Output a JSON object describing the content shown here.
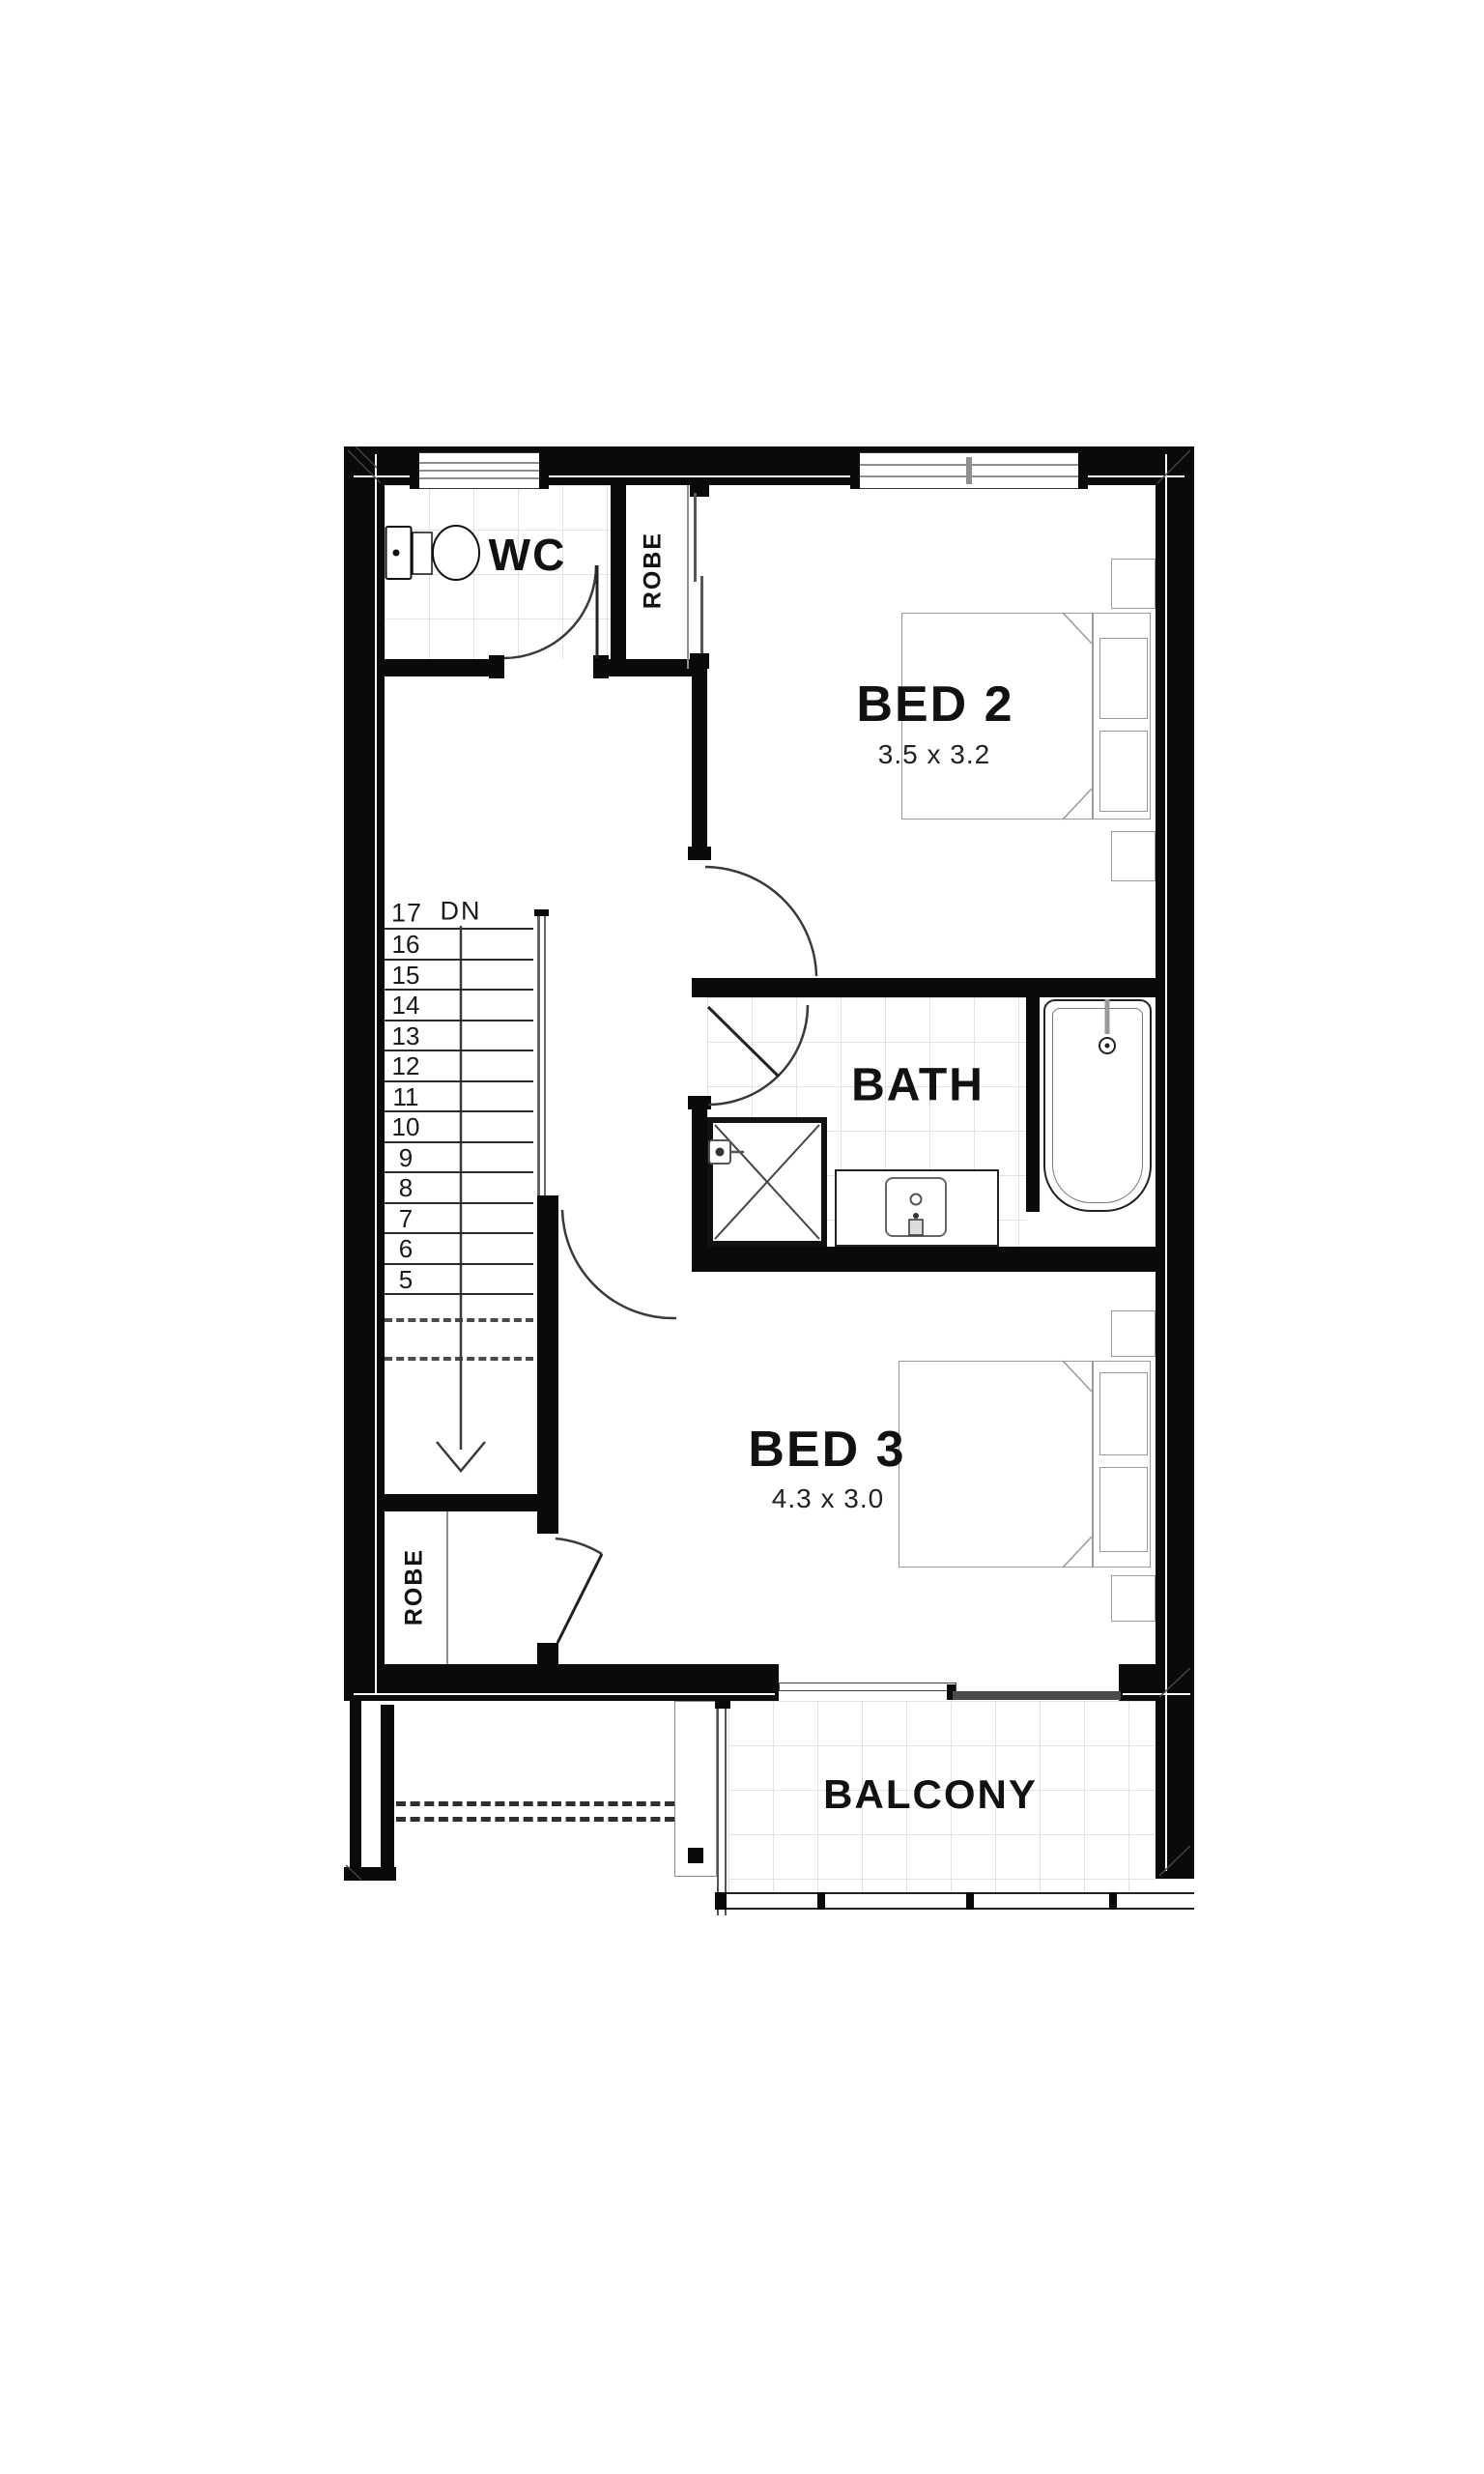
{
  "floorplan": {
    "rooms": {
      "wc": {
        "name": "WC"
      },
      "robe_upper": {
        "name": "ROBE"
      },
      "bed2": {
        "name": "BED 2",
        "size": "3.5 x 3.2"
      },
      "bath": {
        "name": "BATH"
      },
      "bed3": {
        "name": "BED 3",
        "size": "4.3 x 3.0"
      },
      "robe_lower": {
        "name": "ROBE"
      },
      "balcony": {
        "name": "BALCONY"
      }
    },
    "stairs": {
      "top_step": "17",
      "direction": "DN",
      "visible_steps": [
        "16",
        "15",
        "14",
        "13",
        "12",
        "11",
        "10",
        "9",
        "8",
        "7",
        "6",
        "5"
      ]
    }
  },
  "colors": {
    "wall": "#0a0a0a",
    "furniture_line": "#9a9a9a",
    "tile_line": "#e2e2e2",
    "text": "#111111"
  }
}
